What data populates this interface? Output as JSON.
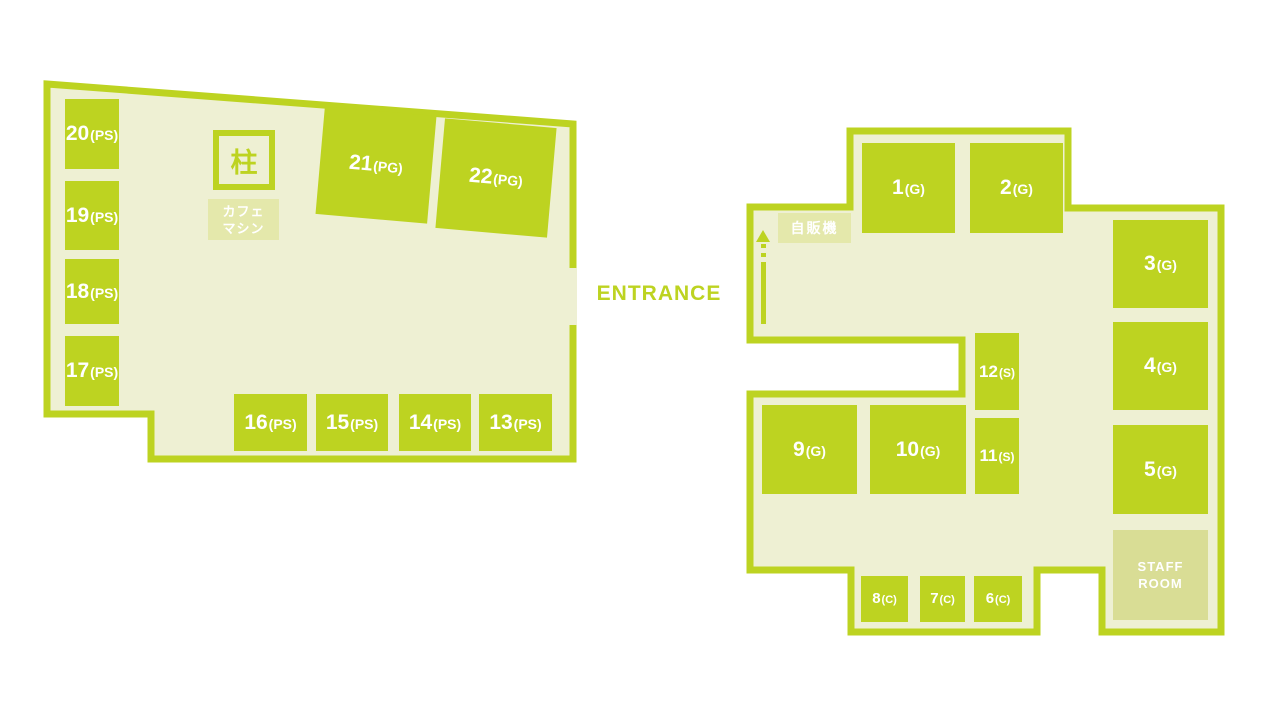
{
  "colors": {
    "accent_green": "#bdd321",
    "floor": "#eef0d3",
    "soft_label_bg": "#e4e8ab",
    "staff_room_bg": "#d9dd95",
    "room_text": "#ffffff"
  },
  "entrance": {
    "label": "ENTRANCE"
  },
  "left_building": {
    "pillar": {
      "label": "柱"
    },
    "cafe_machine": {
      "line1": "カフェ",
      "line2": "マシン"
    },
    "rooms": {
      "r13": {
        "number": "13",
        "suffix": "(PS)"
      },
      "r14": {
        "number": "14",
        "suffix": "(PS)"
      },
      "r15": {
        "number": "15",
        "suffix": "(PS)"
      },
      "r16": {
        "number": "16",
        "suffix": "(PS)"
      },
      "r17": {
        "number": "17",
        "suffix": "(PS)"
      },
      "r18": {
        "number": "18",
        "suffix": "(PS)"
      },
      "r19": {
        "number": "19",
        "suffix": "(PS)"
      },
      "r20": {
        "number": "20",
        "suffix": "(PS)"
      },
      "r21": {
        "number": "21",
        "suffix": "(PG)"
      },
      "r22": {
        "number": "22",
        "suffix": "(PG)"
      }
    }
  },
  "right_building": {
    "vending_machine": {
      "label": "自販機"
    },
    "staff_room": {
      "line1": "STAFF",
      "line2": "ROOM"
    },
    "rooms": {
      "r1": {
        "number": "1",
        "suffix": "(G)"
      },
      "r2": {
        "number": "2",
        "suffix": "(G)"
      },
      "r3": {
        "number": "3",
        "suffix": "(G)"
      },
      "r4": {
        "number": "4",
        "suffix": "(G)"
      },
      "r5": {
        "number": "5",
        "suffix": "(G)"
      },
      "r6": {
        "number": "6",
        "suffix": "(C)"
      },
      "r7": {
        "number": "7",
        "suffix": "(C)"
      },
      "r8": {
        "number": "8",
        "suffix": "(C)"
      },
      "r9": {
        "number": "9",
        "suffix": "(G)"
      },
      "r10": {
        "number": "10",
        "suffix": "(G)"
      },
      "r11": {
        "number": "11",
        "suffix": "(S)"
      },
      "r12": {
        "number": "12",
        "suffix": "(S)"
      }
    }
  }
}
